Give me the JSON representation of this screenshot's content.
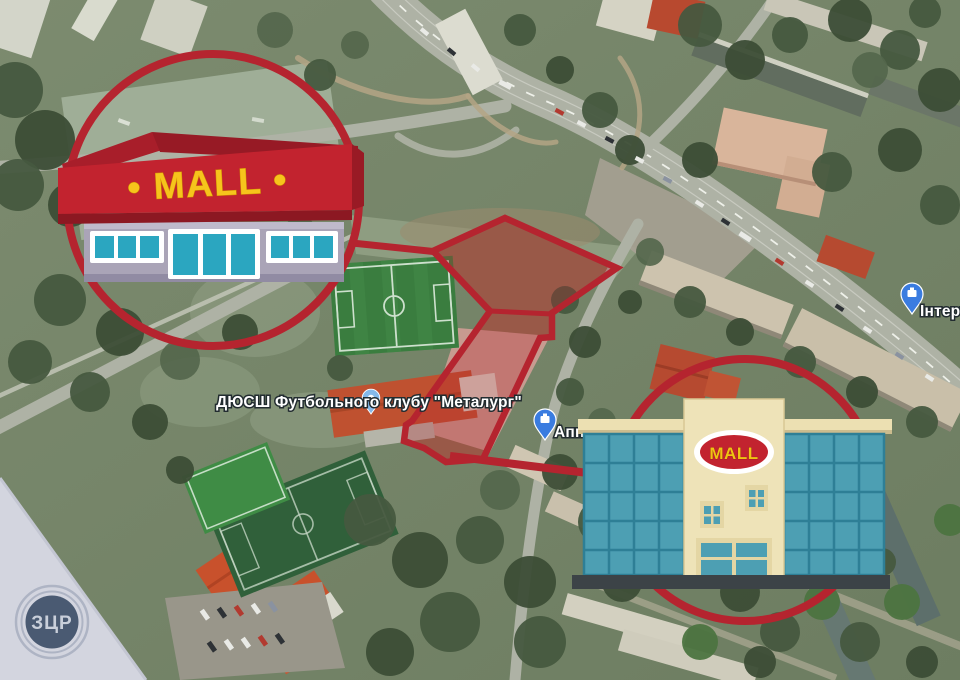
{
  "map_labels": {
    "club": {
      "icon": "map-pin",
      "text": "ДЮСШ Футбольного клубу \"Металург\""
    },
    "appa": {
      "icon": "map-pin",
      "text": "Аппа"
    },
    "intert": {
      "icon": "map-pin",
      "text": "Інтерт"
    }
  },
  "storefront": {
    "sign_text": "• MALL •"
  },
  "building": {
    "sign_text": "MALL"
  },
  "watermark": {
    "text": "ЗЦР"
  },
  "colors": {
    "accent_red": "#b5242f",
    "banner_red": "#c2232f",
    "banner_dark_red": "#9e1b26",
    "sign_yellow": "#f6c41c",
    "storefront_facade": "#aaa4b7",
    "window_teal": "#2ba6c0",
    "glass_teal": "#4d9fb3",
    "building_cream": "#ece0b2",
    "pin_blue": "#3a7ce0",
    "pin_light_blue": "#84b9ea",
    "logo_navy": "#4a5a72",
    "watermark_triangle": "#d3d5df"
  }
}
